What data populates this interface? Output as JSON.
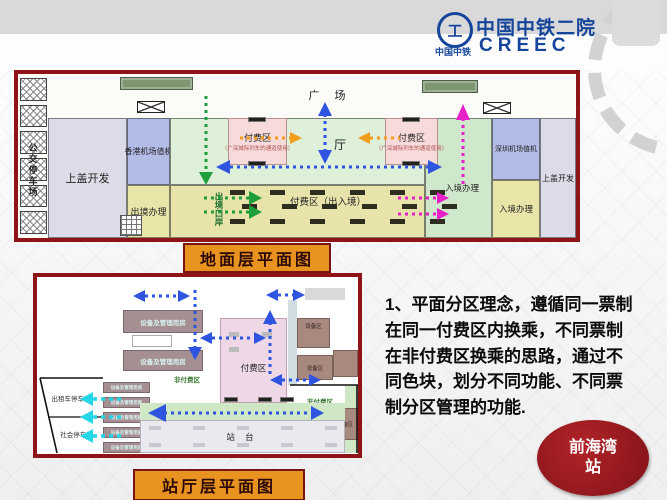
{
  "header": {
    "org_cn": "中国中铁二院",
    "org_en": "CREEC",
    "logo_caption": "中国中铁",
    "logo_glyph": "工"
  },
  "plan1": {
    "caption": "地面层平面图",
    "labels": {
      "plaza": "广  场",
      "bus_parking": "公交停车场",
      "podium": "上盖开发",
      "hk_checkin": "香港机场值机",
      "departure": "出境办理",
      "hall": "厅",
      "paid_zone": "付费区",
      "paid_zone_note": "（广深城际列车的通道使用）",
      "paid_entry_exit": "付费区（出入境）",
      "exit_port": "出境口岸",
      "arrival": "入境办理",
      "sz_checkin": "深圳机场值机"
    }
  },
  "plan2": {
    "caption": "站厅层平面图",
    "labels": {
      "equipment_mgmt": "设备及管理用房",
      "equipment": "设备区",
      "paid_zone": "付费区",
      "unpaid_zone": "非付费区",
      "taxi_parking": "出租车停车场",
      "public_parking": "社会停车场",
      "platform": "站  台"
    }
  },
  "note": {
    "lines": [
      "1、平面分区理念，遵循同一票制",
      "在同一付费区内换乘，不同票制",
      "在非付费区换乘的思路，通过不",
      "同色块，划分不同功能、不同票",
      "制分区管理的功能."
    ]
  },
  "badge": {
    "line1": "前海湾",
    "line2": "站"
  },
  "colors": {
    "frame_red": "#8f1418",
    "caption_orange": "#e8931f",
    "badge_red": "#9b1b20",
    "logo_blue": "#15459a",
    "arrow_blue": "#2f55e0",
    "arrow_green": "#1f9e3c",
    "arrow_orange": "#f49c1c",
    "arrow_magenta": "#e820c8",
    "arrow_cyan": "#25d6e8"
  }
}
